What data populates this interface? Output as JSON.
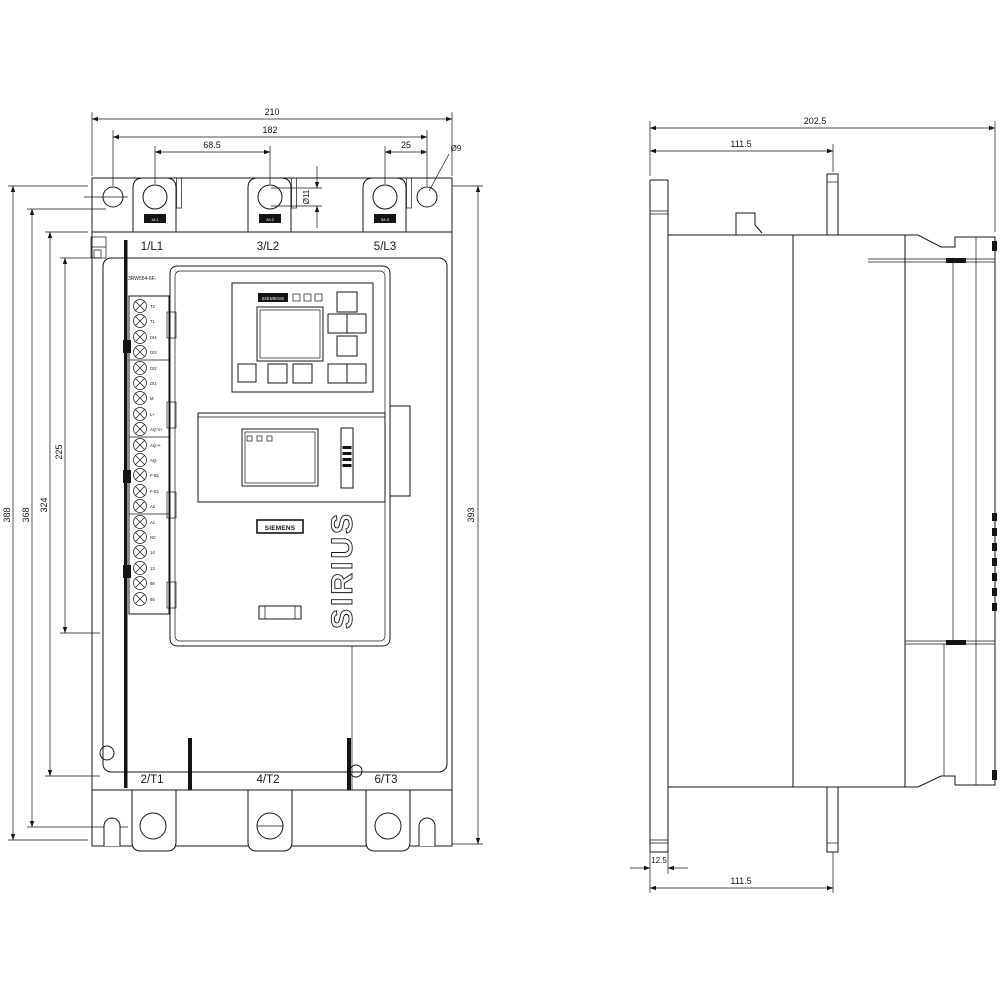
{
  "front": {
    "dims": {
      "w210": "210",
      "w182": "182",
      "w68_5": "68.5",
      "w25": "25",
      "d9": "Ø9",
      "d11": "Ø11",
      "h388": "388",
      "h368": "368",
      "h324": "324",
      "h225": "225",
      "h393": "393"
    },
    "top_terminals": [
      "1/L1",
      "3/L2",
      "5/L3"
    ],
    "bottom_terminals": [
      "2/T1",
      "4/T2",
      "6/T3"
    ],
    "product_code": "3RW554-6F.",
    "hmi_brand": "SIEMENS",
    "front_brand": "SIEMENS",
    "series": "SIRIUS",
    "control_terminals": [
      "T2",
      "T1",
      "DI4",
      "DI3",
      "DI2",
      "DI1",
      "M",
      "L+",
      "AQ-V+",
      "AQ-I+",
      "AQ-",
      "F-B1",
      "F-E1",
      "A2",
      "A1",
      "NC",
      "14",
      "13",
      "98",
      "95"
    ]
  },
  "side": {
    "dims": {
      "d202_5": "202.5",
      "d111_5_top": "111.5",
      "d12_5": "12.5",
      "d111_5_bottom": "111.5"
    }
  }
}
